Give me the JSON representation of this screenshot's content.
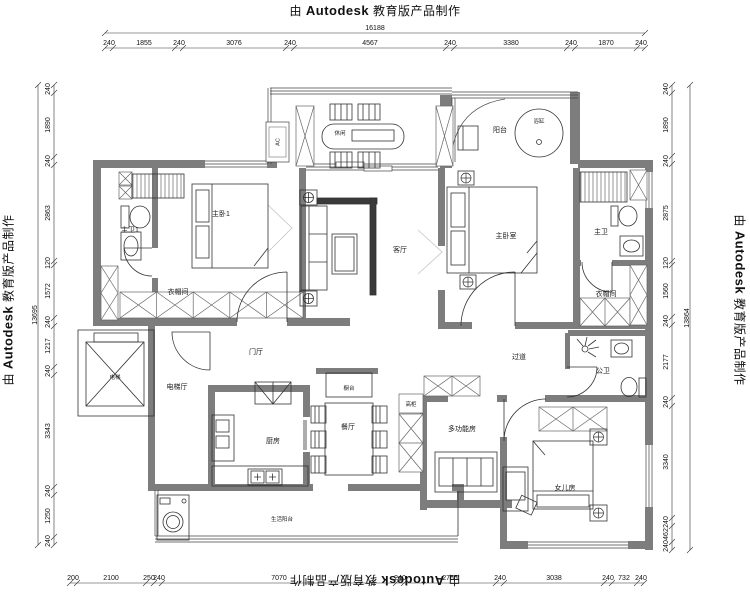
{
  "watermark": {
    "prefix": "由",
    "brand": "Autodesk",
    "suffix": "教育版产品制作"
  },
  "rooms": {
    "master_bath_1": "主卫1",
    "master_bedroom_1": "主卧1",
    "cloakroom_left": "衣帽间",
    "leisure": "休闲",
    "living_room": "客厅",
    "balcony": "阳台",
    "bathtub": "浴缸",
    "master_bedroom": "主卧室",
    "master_bath": "主卫",
    "cloakroom_right": "衣帽间",
    "foyer": "门厅",
    "hallway": "过道",
    "public_bath": "公卫",
    "elevator_hall": "电梯厅",
    "elevator": "电梯",
    "kitchen": "厨房",
    "dining_room": "餐厅",
    "counter": "橱台",
    "tall_cabinet": "高柜",
    "multi_function_room": "多功能房",
    "daughter_room": "女儿房",
    "service_balcony": "生活阳台",
    "ac": "AC"
  },
  "dims": {
    "top": {
      "total": "16188",
      "segments": [
        "240",
        "1855",
        "240",
        "3076",
        "240",
        "4567",
        "240",
        "3380",
        "240",
        "1870",
        "240"
      ]
    },
    "bottom": {
      "segments": [
        "200",
        "2100",
        "250",
        "240",
        "7070",
        "240",
        "2765",
        "240",
        "3038",
        "240",
        "732",
        "240"
      ]
    },
    "left": {
      "total": "13695",
      "segments": [
        "240",
        "1890",
        "240",
        "2863",
        "120",
        "1572",
        "240",
        "1217",
        "240",
        "3343",
        "240",
        "1250",
        "240"
      ]
    },
    "right": {
      "total": "13864",
      "segments": [
        "240",
        "1890",
        "240",
        "2875",
        "120",
        "1560",
        "240",
        "2177",
        "240",
        "3340",
        "240",
        "462",
        "240"
      ]
    }
  }
}
